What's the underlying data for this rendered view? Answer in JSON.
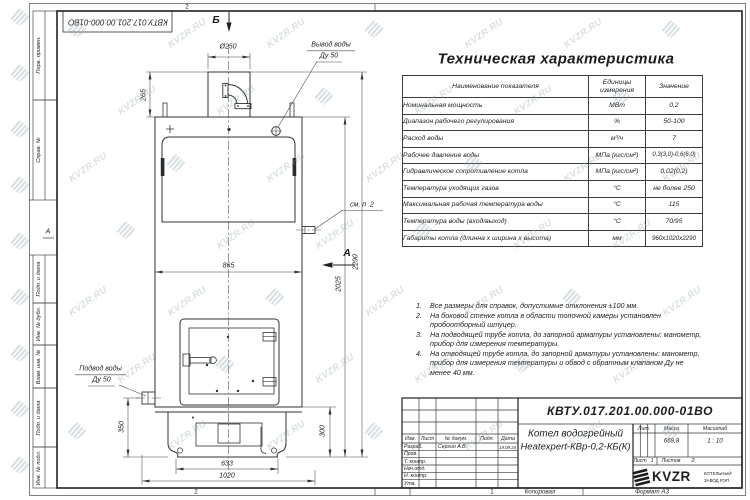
{
  "watermark": {
    "text": "KVZR.RU"
  },
  "frame": {
    "sidebar": [
      "Перв. примен.",
      "Справ. №",
      "Подп. и дата",
      "Инв. № дубл.",
      "Взам. инв. №",
      "Подп. и дата",
      "Инв. № подл."
    ],
    "zone_top": "2",
    "zone_bottom_left": "2",
    "zone_bottom_right": "1",
    "zone_left": "А",
    "footer": {
      "copied": "Копировал",
      "format": "Формат А3"
    }
  },
  "drawing": {
    "view_b": "Б",
    "view_a": "А",
    "labels": {
      "outlet_line1": "Вывод воды",
      "outlet_line2": "Ду 50",
      "inlet_line1": "Подвод воды",
      "inlet_line2": "Ду 50",
      "see_note": "см. п .2"
    },
    "dims": {
      "d250": "Ø250",
      "h265": "265",
      "w865": "865",
      "h2025": "2025",
      "h2290": "2290",
      "h350": "350",
      "w633": "633",
      "w1020": "1020",
      "h300": "300"
    }
  },
  "tech_table": {
    "title": "Техническая характеристика",
    "headers": [
      "Наименование показателя",
      "Единицы измерения",
      "Значение"
    ],
    "rows": [
      [
        "Номинальная мощность",
        "МВт",
        "0,2"
      ],
      [
        "Диапазон рабочего регулирования",
        "%",
        "50-100"
      ],
      [
        "Расход воды",
        "м³/ч",
        "7"
      ],
      [
        "Рабочее давление воды",
        "МПа (кгс/см²)",
        "0,3(3,0)-0,6(6,0)"
      ],
      [
        "Гидравлическое сопротивление котла",
        "МПа (кгс/см²)",
        "0,02(0,2)"
      ],
      [
        "Температура уходящих газов",
        "°С",
        "не более 250"
      ],
      [
        "Максимальная рабочая температура воды",
        "°С",
        "115"
      ],
      [
        "Температура воды (вход/выход)",
        "°С",
        "70/95"
      ],
      [
        "Габариты котла (длинна х ширина х высота)",
        "мм",
        "960х1020х2290"
      ]
    ]
  },
  "notes": {
    "items": [
      {
        "n": "1.",
        "text": "Все размеры для справок, допустимые отклонения ±100 мм."
      },
      {
        "n": "2.",
        "text": "На боковой стенке котла в области топочной камеры установлен пробоотборный штуцер."
      },
      {
        "n": "3.",
        "text": "На подводящей трубе котла, до запорной арматуры установлены: манометр, прибор для измерения температуры."
      },
      {
        "n": "4.",
        "text": "На отводящей трубе котла, до запорной арматуры установлены: манометр, прибор для измерения температуры и обвод с обратным клапаном Ду не менее 40 мм."
      }
    ]
  },
  "title_block": {
    "doc_number": "КВТУ.017.201.00.000-01ВО",
    "name_line1": "Котел водогрейный",
    "name_line2": "Heatexpert-КВр-0,2-КБ(К)",
    "header_cols": [
      "Изм.",
      "Лист",
      "№ докум.",
      "Подп.",
      "Дата"
    ],
    "rows": [
      {
        "label": "Разраб.",
        "name": "Сергин А.В.",
        "date": "19.09.24"
      },
      {
        "label": "Пров.",
        "name": "",
        "date": ""
      },
      {
        "label": "Т. контр.",
        "name": "",
        "date": ""
      },
      {
        "label": "Нач.отд.",
        "name": "",
        "date": ""
      },
      {
        "label": "Н. контр.",
        "name": "",
        "date": ""
      },
      {
        "label": "Утв.",
        "name": "",
        "date": ""
      }
    ],
    "lit_label": "Лит.",
    "mass_label": "Масса",
    "scale_label": "Масштаб",
    "mass": "669,8",
    "scale": "1 : 10",
    "sheet_label": "Лист",
    "sheet": "1",
    "sheets_label": "Листов",
    "sheets": "2",
    "company_name": "KVZR",
    "company_sub1": "КОТЕЛЬНЫЙ",
    "company_sub2": "ЗАВОД РЭП"
  }
}
